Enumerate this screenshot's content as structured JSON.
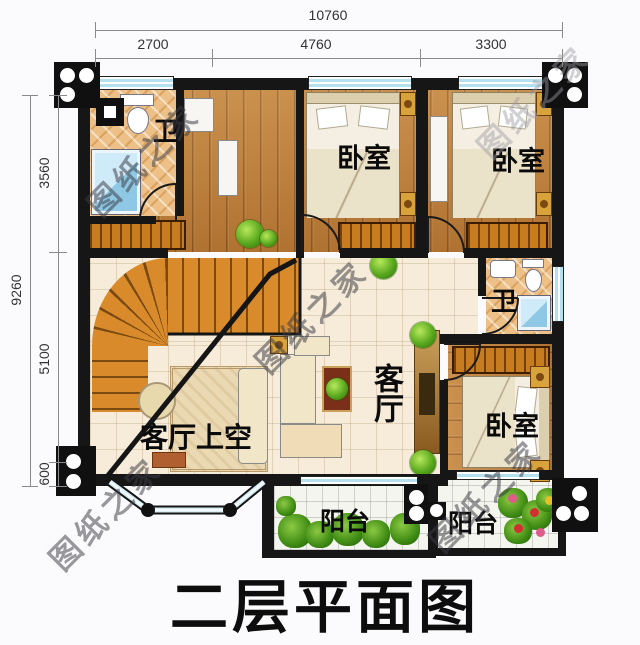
{
  "title": "二层平面图",
  "watermark": "图纸之家",
  "dimensions": {
    "top_total": "10760",
    "top_segments": [
      "2700",
      "4760",
      "3300"
    ],
    "left_total": "9260",
    "left_segments": [
      "3560",
      "5100",
      "600"
    ]
  },
  "rooms": {
    "bath_top": "卫",
    "bath_right": "卫",
    "bedroom_top_middle": "卧室",
    "bedroom_top_right": "卧室",
    "bedroom_bottom_right": "卧室",
    "living": "客厅",
    "living_void": "客厅上空",
    "balcony_left": "阳台",
    "balcony_right": "阳台"
  },
  "colors": {
    "wall": "#161616",
    "wood_floor": "#bf7f3a",
    "bath_tile": "#ecc087",
    "living_tile": "#f6ecd9",
    "balcony_tile": "#f5f5f0",
    "stair": "#d98a2b",
    "shower": "#8fc8e4",
    "plant_green": "#3f8c14",
    "window_glass": "#b5e0f0"
  }
}
